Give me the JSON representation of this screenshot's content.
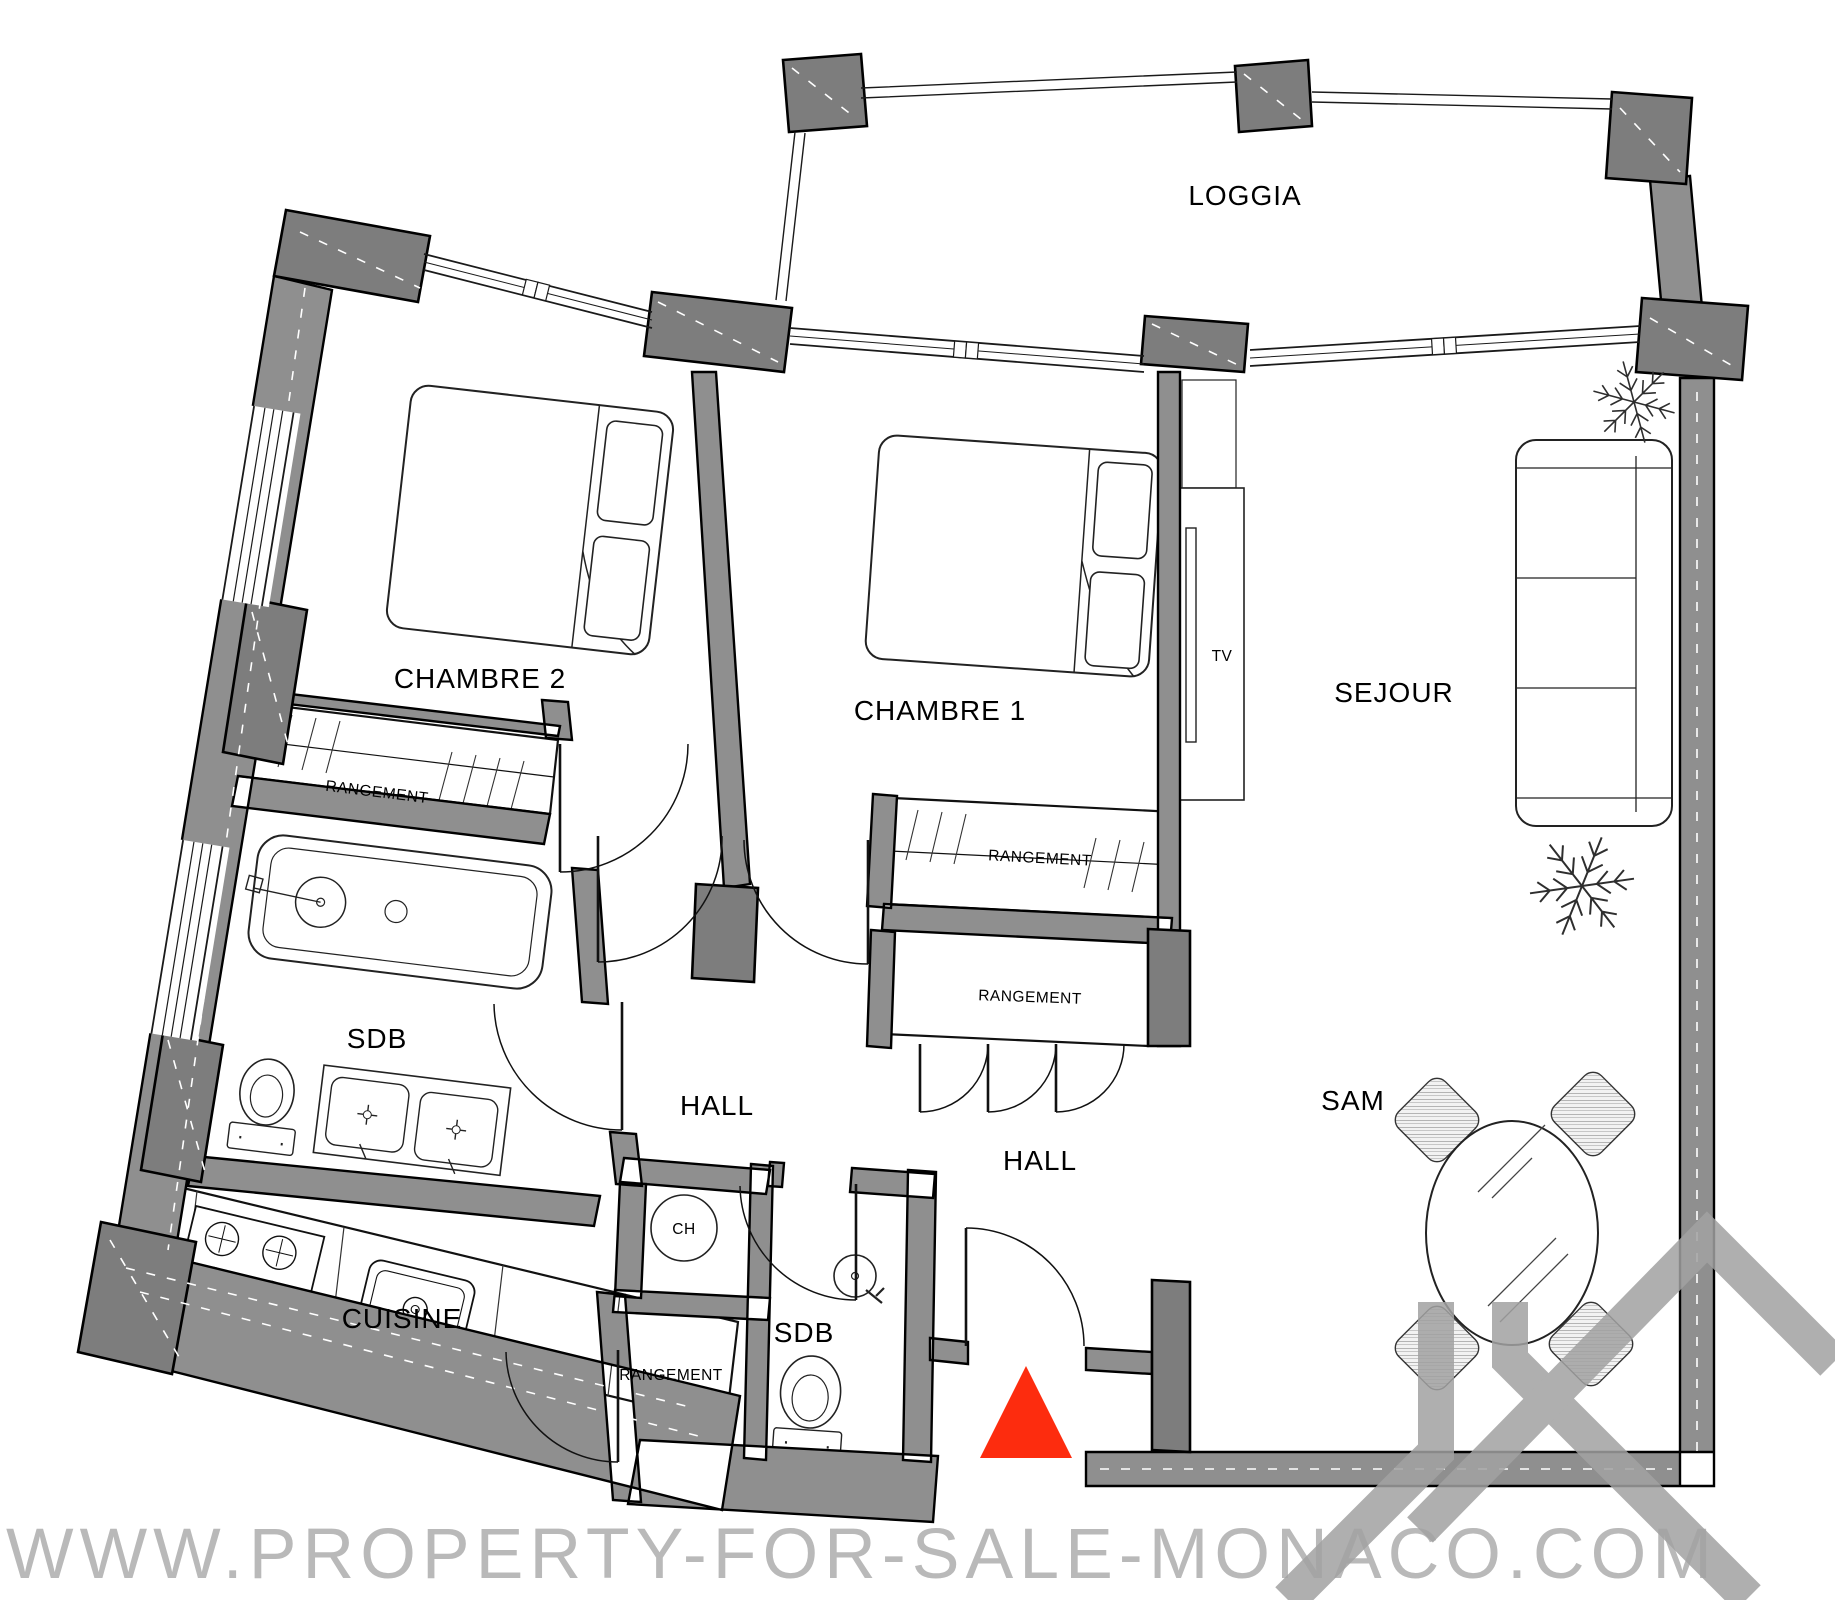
{
  "floorplan": {
    "labels": {
      "loggia": "LOGGIA",
      "chambre2": "CHAMBRE 2",
      "chambre1": "CHAMBRE 1",
      "sejour": "SEJOUR",
      "sam": "SAM",
      "hall_main": "HALL",
      "hall_entry": "HALL",
      "sdb_main": "SDB",
      "sdb_guest": "SDB",
      "cuisine": "CUISINE",
      "rangement_chambre2": "RANGEMENT",
      "rangement_chambre1": "RANGEMENT",
      "rangement_hall": "RANGEMENT",
      "rangement_entry": "RANGEMENT",
      "tv_unit": "TV",
      "water_heater": "CH"
    },
    "colors": {
      "wall_gray": "#8f8f8f",
      "pillar_gray": "#7d7d7d",
      "entrance_red": "#fd2c0e",
      "logo_gray": "#a2a2a2",
      "watermark_gray": "#b9b9b9",
      "line_black": "#000000"
    },
    "entrance_marker": "red-triangle"
  },
  "watermark": {
    "text": "WWW.PROPERTY-FOR-SALE-MONACO.COM"
  }
}
